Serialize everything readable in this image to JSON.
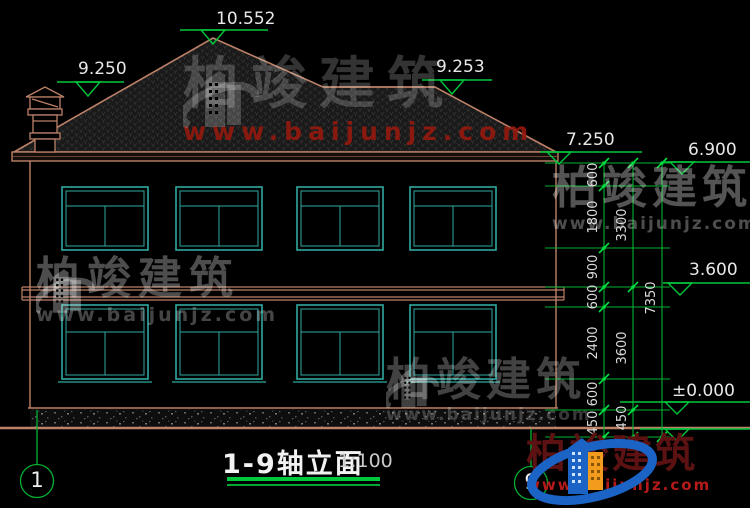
{
  "drawing_title": {
    "label": "1-9轴立面",
    "scale": "1:100"
  },
  "elevations": {
    "ridge": "10.552",
    "left_hip": "9.250",
    "right_hip": "9.253",
    "eave_top": "7.250",
    "eave": "6.900",
    "second_floor": "3.600",
    "ground_floor": "±0.000"
  },
  "dimensions": {
    "chain_detail": [
      "600",
      "1800",
      "900",
      "600",
      "2400",
      "600",
      "450"
    ],
    "chain_mid": [
      "3300",
      "3600",
      "450"
    ],
    "chain_total": [
      "7350"
    ]
  },
  "axes": {
    "left": "1",
    "right": "9"
  },
  "watermark": {
    "brand": "柏竣建筑",
    "url": "www.baijunjz.com"
  },
  "logo": {
    "brand": "柏竣建筑",
    "url": "www.baijunjz.com"
  },
  "colors": {
    "background": "#000000",
    "line_tan": "#bd8168",
    "line_teal": "#2fa8a0",
    "dim_green": "#00b232",
    "text_white": "#e8e8e8",
    "watermark_red": "#96180e",
    "logo_blue": "#1b63c4",
    "logo_orange": "#f29b1d",
    "logo_red": "#b51a1a"
  }
}
